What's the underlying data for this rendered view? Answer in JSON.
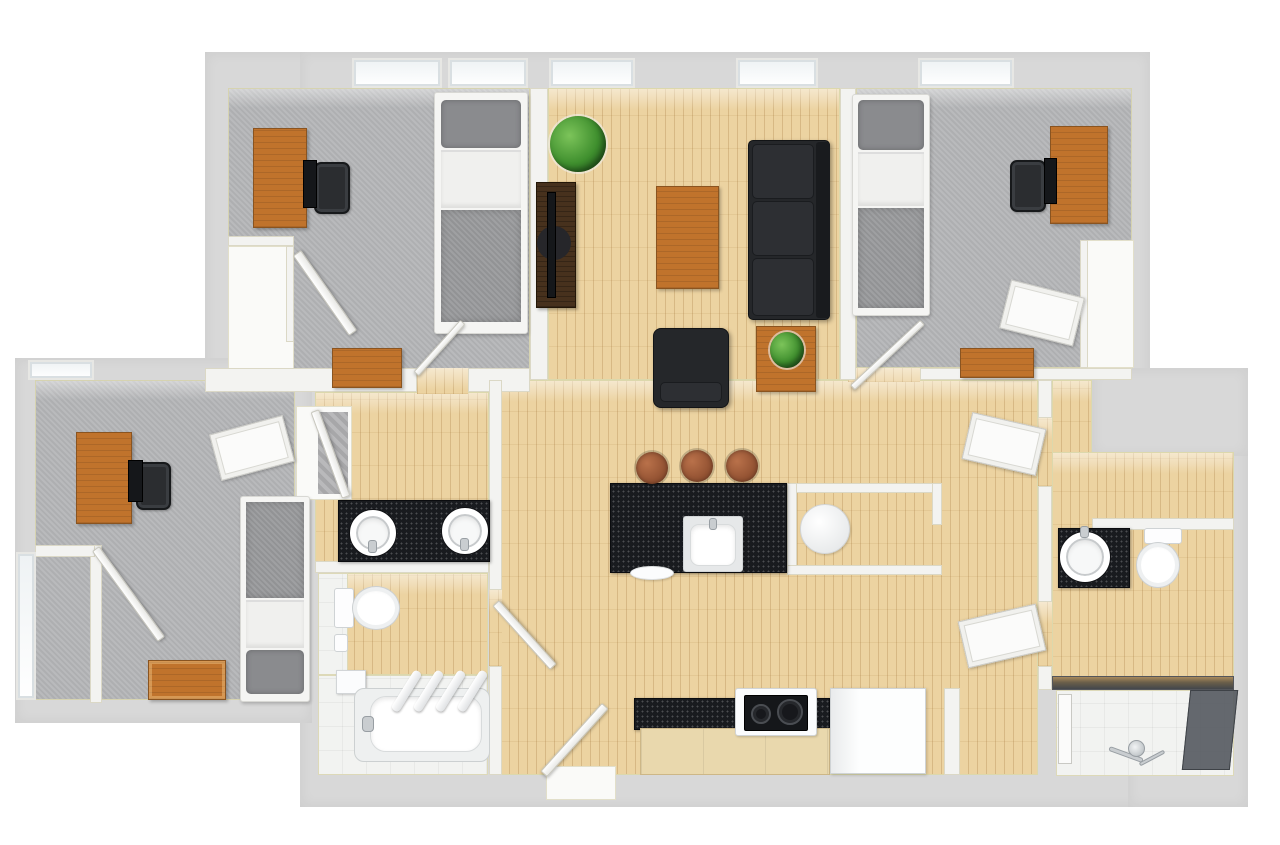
{
  "title": "3D top-down floor plan of a three-bedroom apartment with two bathrooms, open kitchen and living area",
  "palette": {
    "wall": "#d8d8d8",
    "wallInner": "#f3f3f1",
    "trim": "#dcd8ac",
    "carpet": "#b5b6b8",
    "wood": "#ecd3a1",
    "tile": "#f2f3f1",
    "counter": "#191b1f",
    "furnWood": "#c0732c",
    "darkWood": "#47311d",
    "sofaBlack": "#25272a",
    "plant": "#3f8f2e",
    "steel": "#c9cdd0",
    "fixture": "#fbfcfd",
    "glass": "#54595f",
    "copper": "#8f4f30",
    "blanket": "#9a9b9d",
    "pillow": "#8a8b8e",
    "sheet": "#f0f0ee"
  },
  "rooms": [
    {
      "id": "bedroom-top-left",
      "floor": "carpet",
      "contents": [
        "desk",
        "office-chair",
        "monitor",
        "twin-bed",
        "dresser",
        "closet",
        "closet-door",
        "room-door",
        "window",
        "window"
      ]
    },
    {
      "id": "living-room",
      "floor": "hardwood",
      "contents": [
        "potted-plant",
        "tv-stand",
        "television",
        "coffee-table",
        "three-seat-sofa",
        "armchair",
        "side-table",
        "small-plant",
        "window",
        "window"
      ]
    },
    {
      "id": "bedroom-top-right",
      "floor": "carpet",
      "contents": [
        "twin-bed",
        "desk",
        "office-chair",
        "monitor",
        "dresser",
        "closet",
        "closet-door",
        "room-door",
        "window"
      ]
    },
    {
      "id": "bedroom-left-wing",
      "floor": "carpet",
      "contents": [
        "desk",
        "office-chair",
        "monitor",
        "twin-bed",
        "storage-chest",
        "closet",
        "closet-door",
        "room-door",
        "window",
        "window"
      ]
    },
    {
      "id": "main-bathroom",
      "floor": "hardwood-and-tile",
      "contents": [
        "double-sink-vanity",
        "two-round-sinks",
        "toilet",
        "toilet-paper-holder",
        "bathtub",
        "tub-faucet",
        "four-towels",
        "step-shelf",
        "door"
      ]
    },
    {
      "id": "kitchen-dining",
      "floor": "hardwood",
      "contents": [
        "kitchen-island",
        "island-sink",
        "bar-stool",
        "bar-stool",
        "bar-stool",
        "breakfast-nook",
        "round-table",
        "black-counter",
        "cooktop",
        "base-cabinets",
        "refrigerator",
        "entry-door"
      ]
    },
    {
      "id": "hallway",
      "floor": "hardwood",
      "contents": [
        "door",
        "door"
      ]
    },
    {
      "id": "second-bathroom",
      "floor": "hardwood-and-tile",
      "contents": [
        "sink-vanity",
        "round-sink",
        "toilet",
        "walk-in-shower",
        "glass-panel",
        "shower-head"
      ]
    }
  ]
}
